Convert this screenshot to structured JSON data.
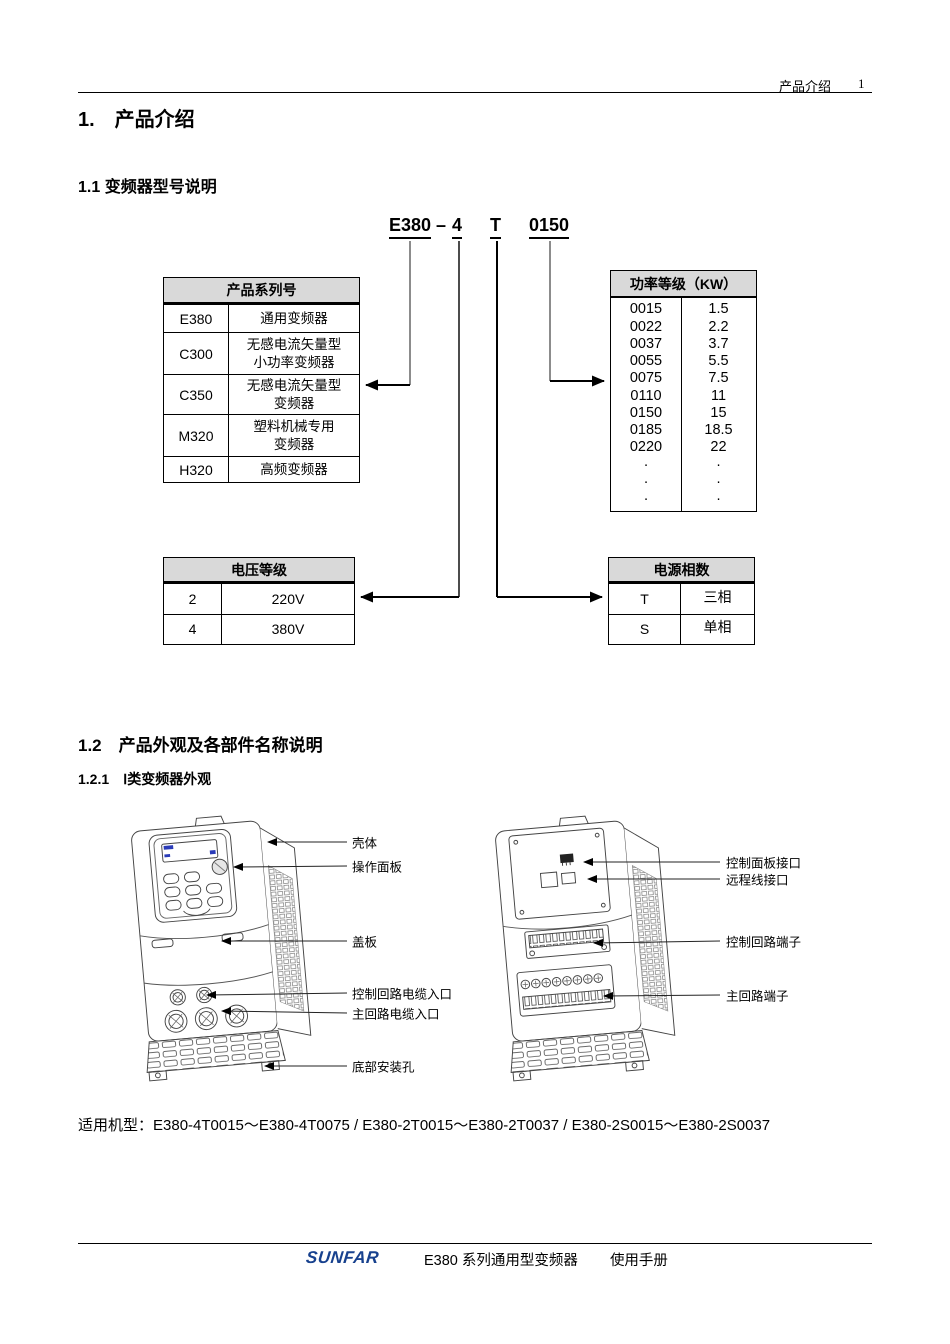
{
  "header": {
    "doc_section": "产品介绍",
    "page_number": "1"
  },
  "headings": {
    "title": "1.　产品介绍",
    "s1_1": "1.1 变频器型号说明",
    "s1_2": "1.2　产品外观及各部件名称说明",
    "s1_2_1": "1.2.1　Ⅰ类变频器外观"
  },
  "model_code": {
    "series": "E380",
    "dash": "–",
    "voltage": "4",
    "phase": "T",
    "power": "0150"
  },
  "series_table": {
    "title": "产品系列号",
    "rows": [
      {
        "code": "E380",
        "name": "通用变频器"
      },
      {
        "code": "C300",
        "name": "无感电流矢量型",
        "name2": "小功率变频器"
      },
      {
        "code": "C350",
        "name": "无感电流矢量型",
        "name2": "变频器"
      },
      {
        "code": "M320",
        "name": "塑料机械专用",
        "name2": "变频器"
      },
      {
        "code": "H320",
        "name": "高频变频器"
      }
    ]
  },
  "power_table": {
    "title": "功率等级（KW）",
    "rows": [
      {
        "code": "0015",
        "kw": "1.5"
      },
      {
        "code": "0022",
        "kw": "2.2"
      },
      {
        "code": "0037",
        "kw": "3.7"
      },
      {
        "code": "0055",
        "kw": "5.5"
      },
      {
        "code": "0075",
        "kw": "7.5"
      },
      {
        "code": "0110",
        "kw": "11"
      },
      {
        "code": "0150",
        "kw": "15"
      },
      {
        "code": "0185",
        "kw": "18.5"
      },
      {
        "code": "0220",
        "kw": "22"
      },
      {
        "code": "·",
        "kw": "·"
      },
      {
        "code": "·",
        "kw": "·"
      },
      {
        "code": "·",
        "kw": "·"
      }
    ]
  },
  "voltage_table": {
    "title": "电压等级",
    "rows": [
      {
        "code": "2",
        "value": "220V"
      },
      {
        "code": "4",
        "value": "380V"
      }
    ]
  },
  "phase_table": {
    "title": "电源相数",
    "rows": [
      {
        "code": "T",
        "value": "三相"
      },
      {
        "code": "S",
        "value": "单相"
      }
    ]
  },
  "figure_left": {
    "labels": [
      "壳体",
      "操作面板",
      "盖板",
      "控制回路电缆入口",
      "主回路电缆入口",
      "底部安装孔"
    ]
  },
  "figure_right": {
    "labels": [
      "控制面板接口",
      "远程线接口",
      "控制回路端子",
      "主回路端子"
    ]
  },
  "applicable_models": "适用机型：E380-4T0015～E380-4T0075 / E380-2T0015～E380-2T0037 / E380-2S0015～E380-2S0037",
  "footer": {
    "logo": "SUNFAR",
    "manual_series": "E380 系列通用型变频器",
    "manual_name": "使用手册"
  },
  "colors": {
    "table_header_bg": "#d9d9d9",
    "line": "#000000",
    "logo_blue": "#17418e",
    "display_blue": "#2a3bb8"
  }
}
